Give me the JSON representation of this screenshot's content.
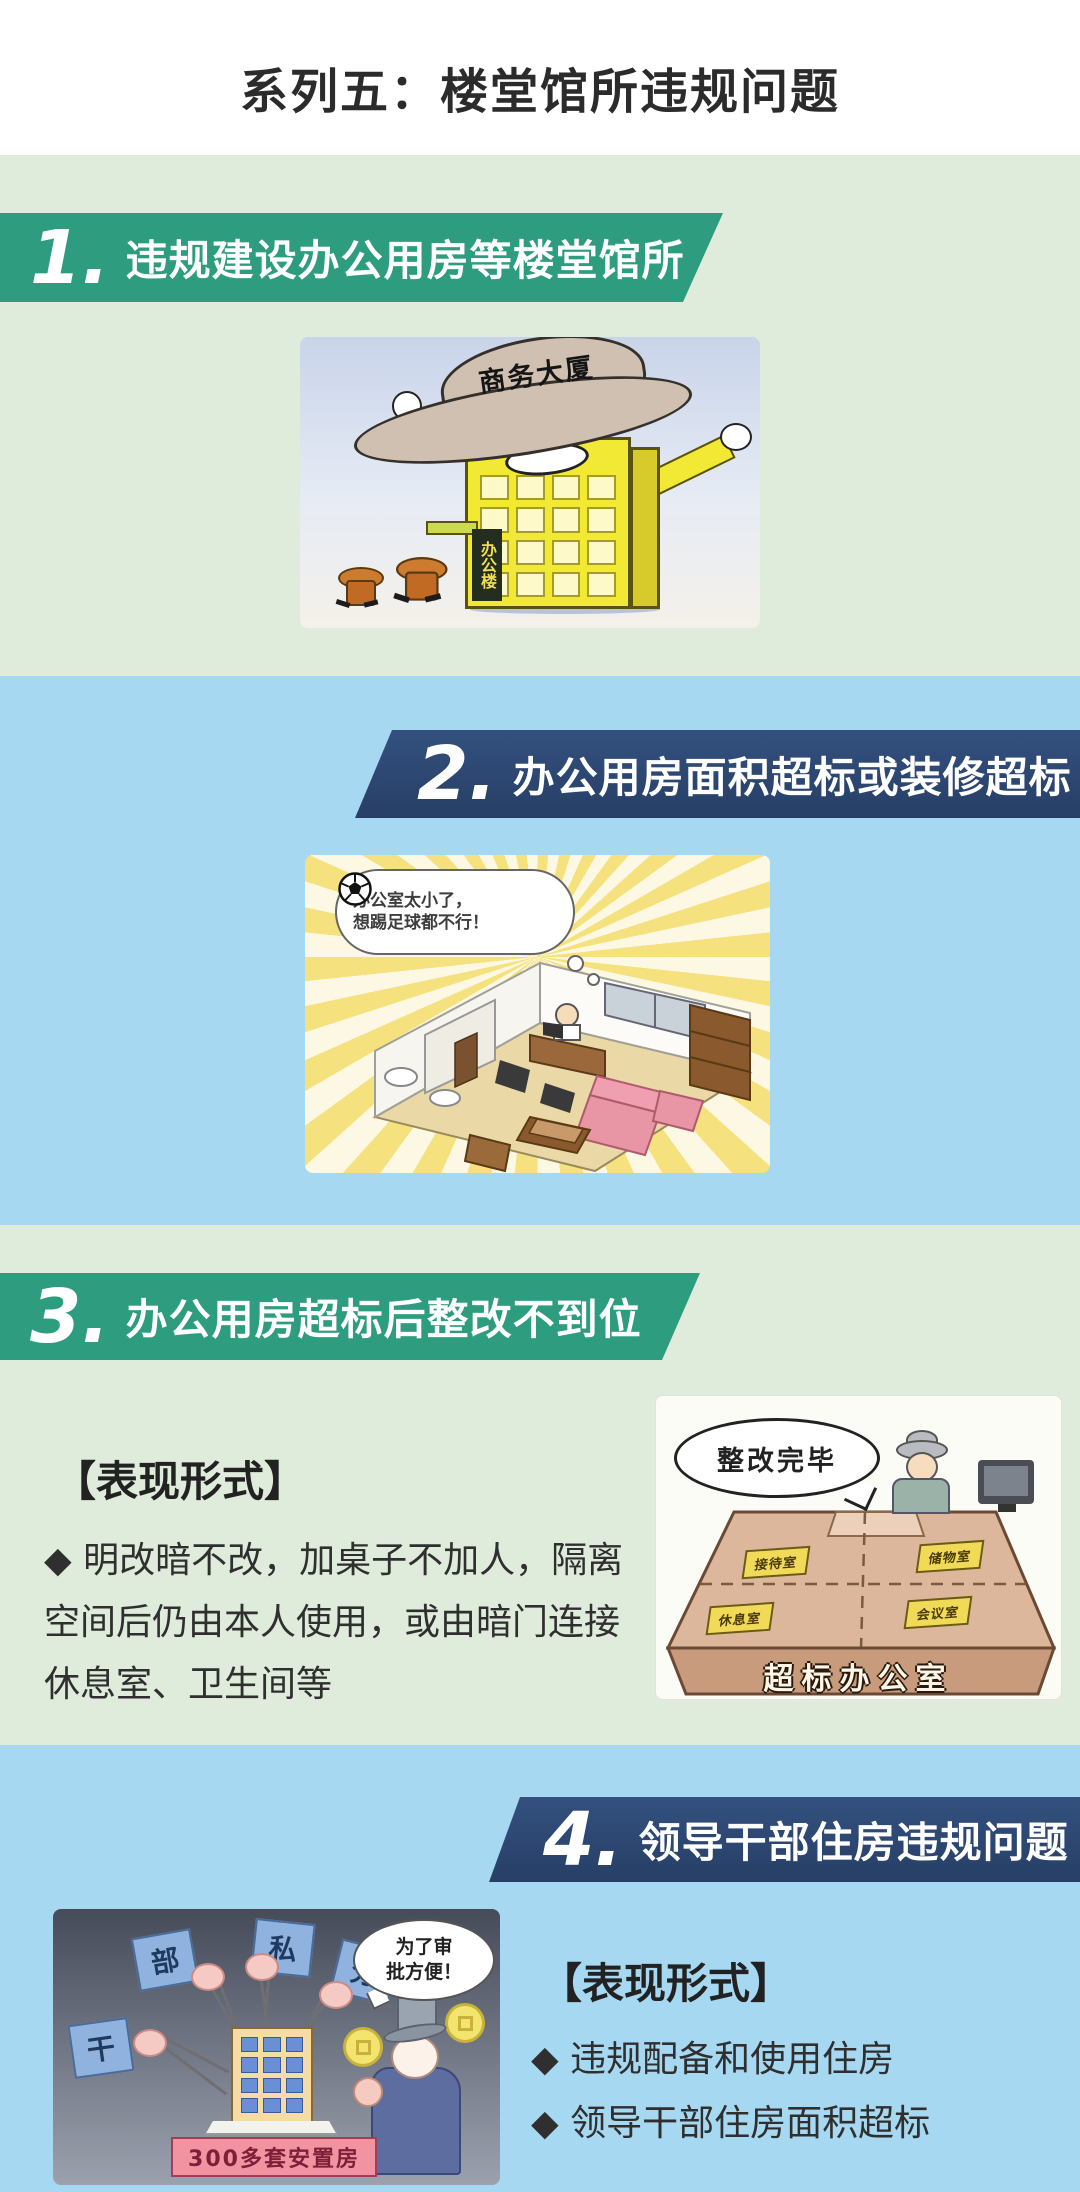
{
  "colors": {
    "page_bg": "#ffffff",
    "light_green_band": "#e0ecdb",
    "light_blue_band": "#a7d8f1",
    "green_banner": "#2e9c7e",
    "navy_banner": "#2e4a74",
    "title_text": "#2b2b2b"
  },
  "header": {
    "title": "系列五：楼堂馆所违规问题"
  },
  "sections": [
    {
      "number": "1.",
      "heading": "违规建设办公用房等楼堂馆所",
      "cartoon": {
        "hat_label": "商务大厦",
        "building_sign": "办公楼"
      }
    },
    {
      "number": "2.",
      "heading": "办公用房面积超标或装修超标",
      "cartoon": {
        "speech_line1": "办公室太小了，",
        "speech_line2": "想踢足球都不行！"
      }
    },
    {
      "number": "3.",
      "heading": "办公用房超标后整改不到位",
      "subheading": "【表现形式】",
      "bullet": "◆ 明改暗不改，加桌子不加人，隔离空间后仍由本人使用，或由暗门连接休息室、卫生间等",
      "cartoon": {
        "speech": "整改完毕",
        "signs": [
          "接待室",
          "储物室",
          "休息室",
          "会议室"
        ],
        "desk_label": "超标办公室"
      }
    },
    {
      "number": "4.",
      "heading": "领导干部住房违规问题",
      "subheading": "【表现形式】",
      "bullets": [
        "◆ 违规配备和使用住房",
        "◆ 领导干部住房面积超标"
      ],
      "cartoon": {
        "flags": [
          "干",
          "部",
          "私",
          "分"
        ],
        "speech_line1": "为了审",
        "speech_line2": "批方便！",
        "banner": "300多套安置房"
      }
    }
  ]
}
